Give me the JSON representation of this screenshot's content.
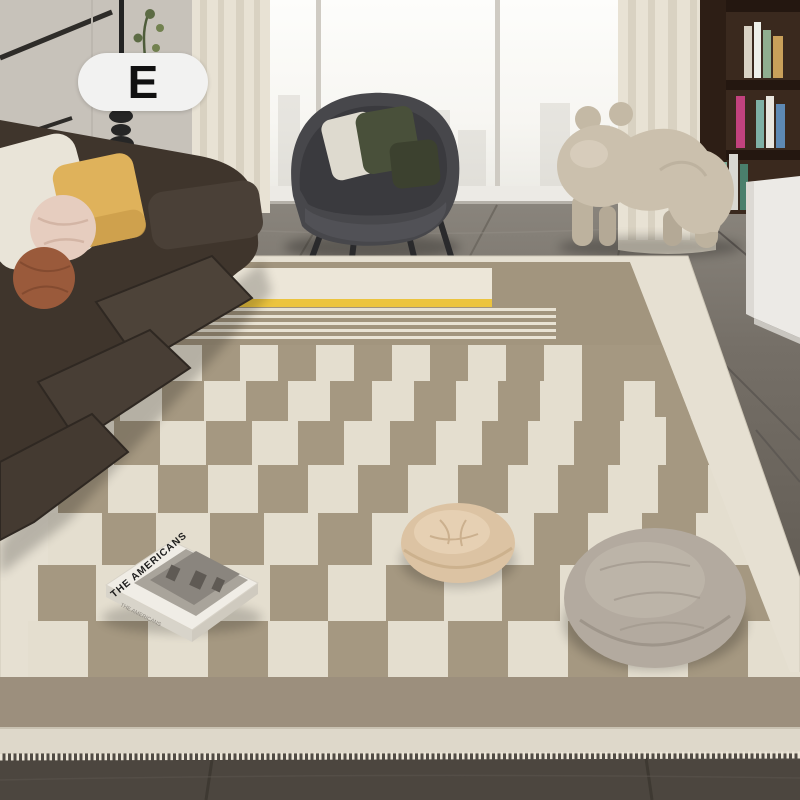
{
  "badge": {
    "label": "E"
  },
  "book": {
    "title": "THE AMERICANS",
    "spine": "THE AMERICANS"
  },
  "palette": {
    "badge_bg": "#f2f2f1",
    "badge_text": "#111111",
    "rug_cream": "#e6e0d2",
    "rug_taupe": "#a59881",
    "rug_bottom_band": "#9c8f7d",
    "accent_yellow": "#ecc43e",
    "floor_upper": "#827d75",
    "floor_lower": "#4e4840",
    "sofa_leather": "#3f352c",
    "pillow_cream": "#e9e4d8",
    "pillow_yellow": "#dfb25b",
    "pillow_pink": "#e6cdbf",
    "pillow_rust": "#9a5a3b",
    "armchair_gray": "#47474b",
    "chair_pillow_green": "#49503a",
    "dog_beige": "#cbc0ad",
    "pouf_beige": "#dcc3a3",
    "pouf_gray": "#b3aa9f",
    "wall_left": "#ccc7bf",
    "curtain": "#e8e2d4",
    "window_glass": "#f9f8f5",
    "bookshelf_wood": "#3a291e",
    "cabinet_white": "#eceae6"
  },
  "rug": {
    "checker": {
      "cols": 16,
      "cream": "#e4decf",
      "taupe": "#a59881",
      "rows": [
        {
          "y": 345,
          "h": 36,
          "w": 38,
          "x0": 88
        },
        {
          "y": 381,
          "h": 40,
          "w": 42,
          "x0": 78
        },
        {
          "y": 421,
          "h": 44,
          "w": 46,
          "x0": 68
        },
        {
          "y": 465,
          "h": 48,
          "w": 50,
          "x0": 58
        },
        {
          "y": 513,
          "h": 52,
          "w": 54,
          "x0": 48
        },
        {
          "y": 565,
          "h": 56,
          "w": 58,
          "x0": 38
        },
        {
          "y": 621,
          "h": 56,
          "w": 60,
          "x0": 28
        }
      ]
    }
  }
}
